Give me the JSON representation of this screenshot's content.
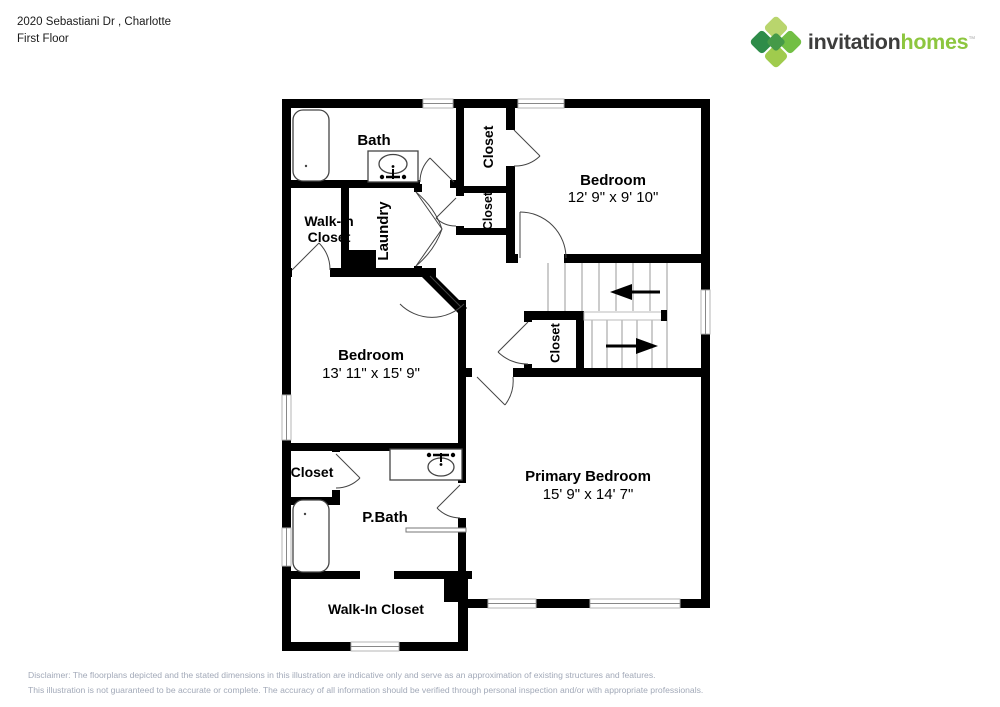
{
  "header": {
    "address": "2020 Sebastiani Dr , Charlotte",
    "floor_label": "First Floor"
  },
  "logo": {
    "brand_word1": "invitation",
    "brand_word2": "homes",
    "trademark": "™"
  },
  "floorplan": {
    "rooms": {
      "bath": {
        "label": "Bath"
      },
      "closet_bedroom2": {
        "label": "Closet"
      },
      "closet_hall": {
        "label": "Closet"
      },
      "bedroom2": {
        "label": "Bedroom",
        "dimensions": "12' 9\" x 9' 10\""
      },
      "walkin_closet_upper": {
        "label_line1": "Walk-In",
        "label_line2": "Closet"
      },
      "laundry": {
        "label": "Laundry"
      },
      "bedroom1": {
        "label": "Bedroom",
        "dimensions": "13' 11\" x 15' 9\""
      },
      "closet_stairs": {
        "label": "Closet"
      },
      "primary_bedroom": {
        "label": "Primary Bedroom",
        "dimensions": "15' 9\" x 14' 7\""
      },
      "closet_pbath": {
        "label": "Closet"
      },
      "pbath": {
        "label": "P.Bath"
      },
      "walkin_closet_lower": {
        "label": "Walk-In Closet"
      }
    }
  },
  "disclaimer": {
    "line1": "Disclaimer: The floorplans depicted and the stated dimensions in this illustration are indicative only and serve as an approximation of existing structures and features.",
    "line2": "This illustration is not guaranteed to be accurate or complete. The accuracy of all information should be verified through personal inspection and/or with appropriate professionals."
  },
  "colors": {
    "wall": "#000000",
    "brand_green": "#8dc63f",
    "logo_text": "#3d3d3c",
    "disclaimer_text": "#a2a9b8",
    "door_line": "#333333"
  }
}
